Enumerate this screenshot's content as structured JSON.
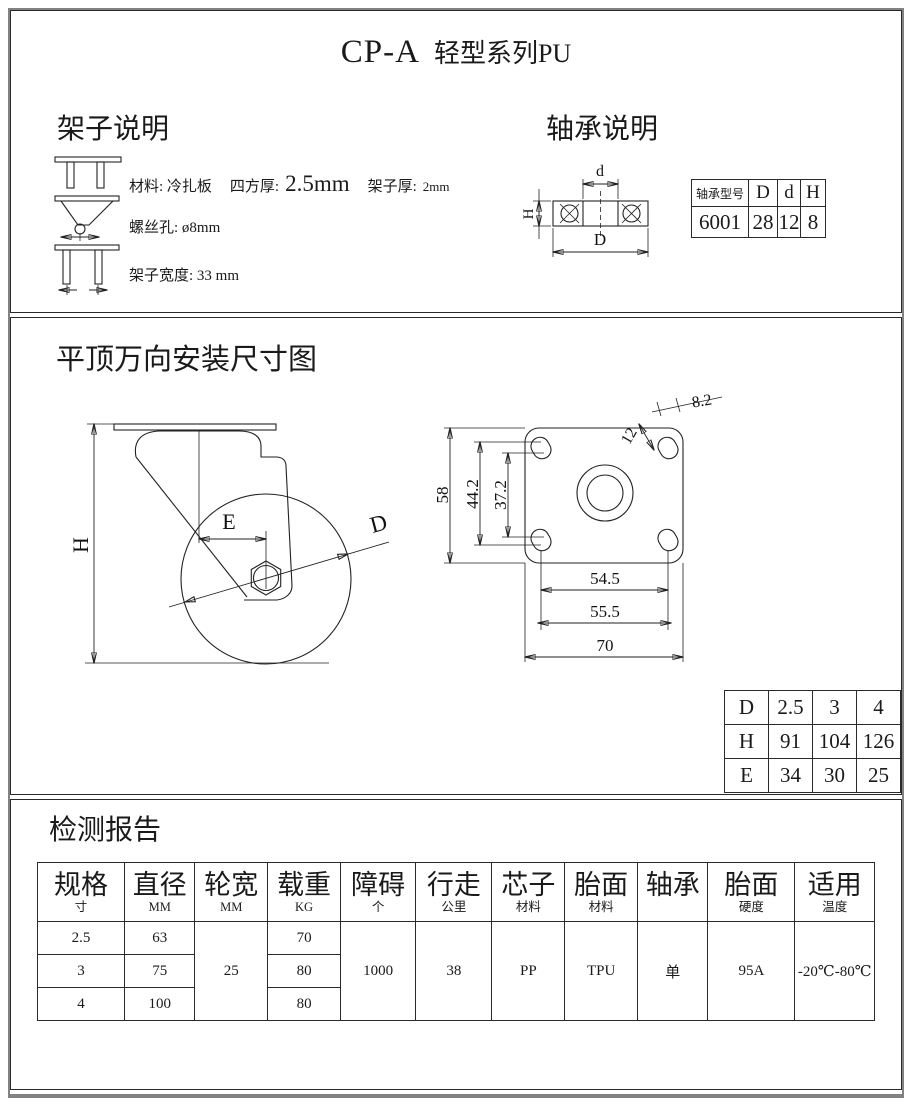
{
  "page": {
    "model": "CP-A",
    "series": "轻型系列PU"
  },
  "frame_section": {
    "heading": "架子说明",
    "material_label": "材料: 冷扎板",
    "thickness_label": "四方厚:",
    "thickness_value": "2.5mm",
    "frame_thickness_label": "架子厚:",
    "frame_thickness_value": "2mm",
    "screw_hole": "螺丝孔: ø8mm",
    "frame_width": "架子宽度: 33 mm"
  },
  "bearing_section": {
    "heading": "轴承说明",
    "labels": {
      "d": "d",
      "D": "D",
      "H": "H"
    },
    "table": {
      "model_header": "轴承型号",
      "col_D": "D",
      "col_d": "d",
      "col_H": "H",
      "model": "6001",
      "val_D": "28",
      "val_d": "12",
      "val_H": "8"
    }
  },
  "mounting_section": {
    "heading": "平顶万向安装尺寸图",
    "side_labels": {
      "H": "H",
      "E": "E",
      "D": "D"
    },
    "plate_dims": {
      "plate_height": "58",
      "hole_span_outer": "44.2",
      "hole_span_inner": "37.2",
      "slot_length": "12",
      "slot_width": "8.2",
      "hole_span_h1": "54.5",
      "hole_span_h2": "55.5",
      "plate_width": "70"
    },
    "dhe_table": {
      "row_labels": [
        "D",
        "H",
        "E"
      ],
      "rows": [
        [
          "2.5",
          "3",
          "4"
        ],
        [
          "91",
          "104",
          "126"
        ],
        [
          "34",
          "30",
          "25"
        ]
      ]
    }
  },
  "report_section": {
    "heading": "检测报告",
    "table": {
      "headers": [
        {
          "title": "规格",
          "unit": "寸"
        },
        {
          "title": "直径",
          "unit": "MM"
        },
        {
          "title": "轮宽",
          "unit": "MM"
        },
        {
          "title": "载重",
          "unit": "KG"
        },
        {
          "title": "障碍",
          "unit": "个"
        },
        {
          "title": "行走",
          "unit": "公里"
        },
        {
          "title": "芯子",
          "unit": "材料"
        },
        {
          "title": "胎面",
          "unit": "材料"
        },
        {
          "title": "轴承",
          "unit": ""
        },
        {
          "title": "胎面",
          "unit": "硬度"
        },
        {
          "title": "适用",
          "unit": "温度"
        }
      ],
      "rows": [
        {
          "size": "2.5",
          "diameter": "63",
          "load": "70"
        },
        {
          "size": "3",
          "diameter": "75",
          "load": "80"
        },
        {
          "size": "4",
          "diameter": "100",
          "load": "80"
        }
      ],
      "shared": {
        "wheel_width": "25",
        "obstacles": "1000",
        "distance": "38",
        "core": "PP",
        "tread": "TPU",
        "bearing": "单",
        "hardness": "95A",
        "temperature": "-20℃-80℃"
      }
    }
  }
}
